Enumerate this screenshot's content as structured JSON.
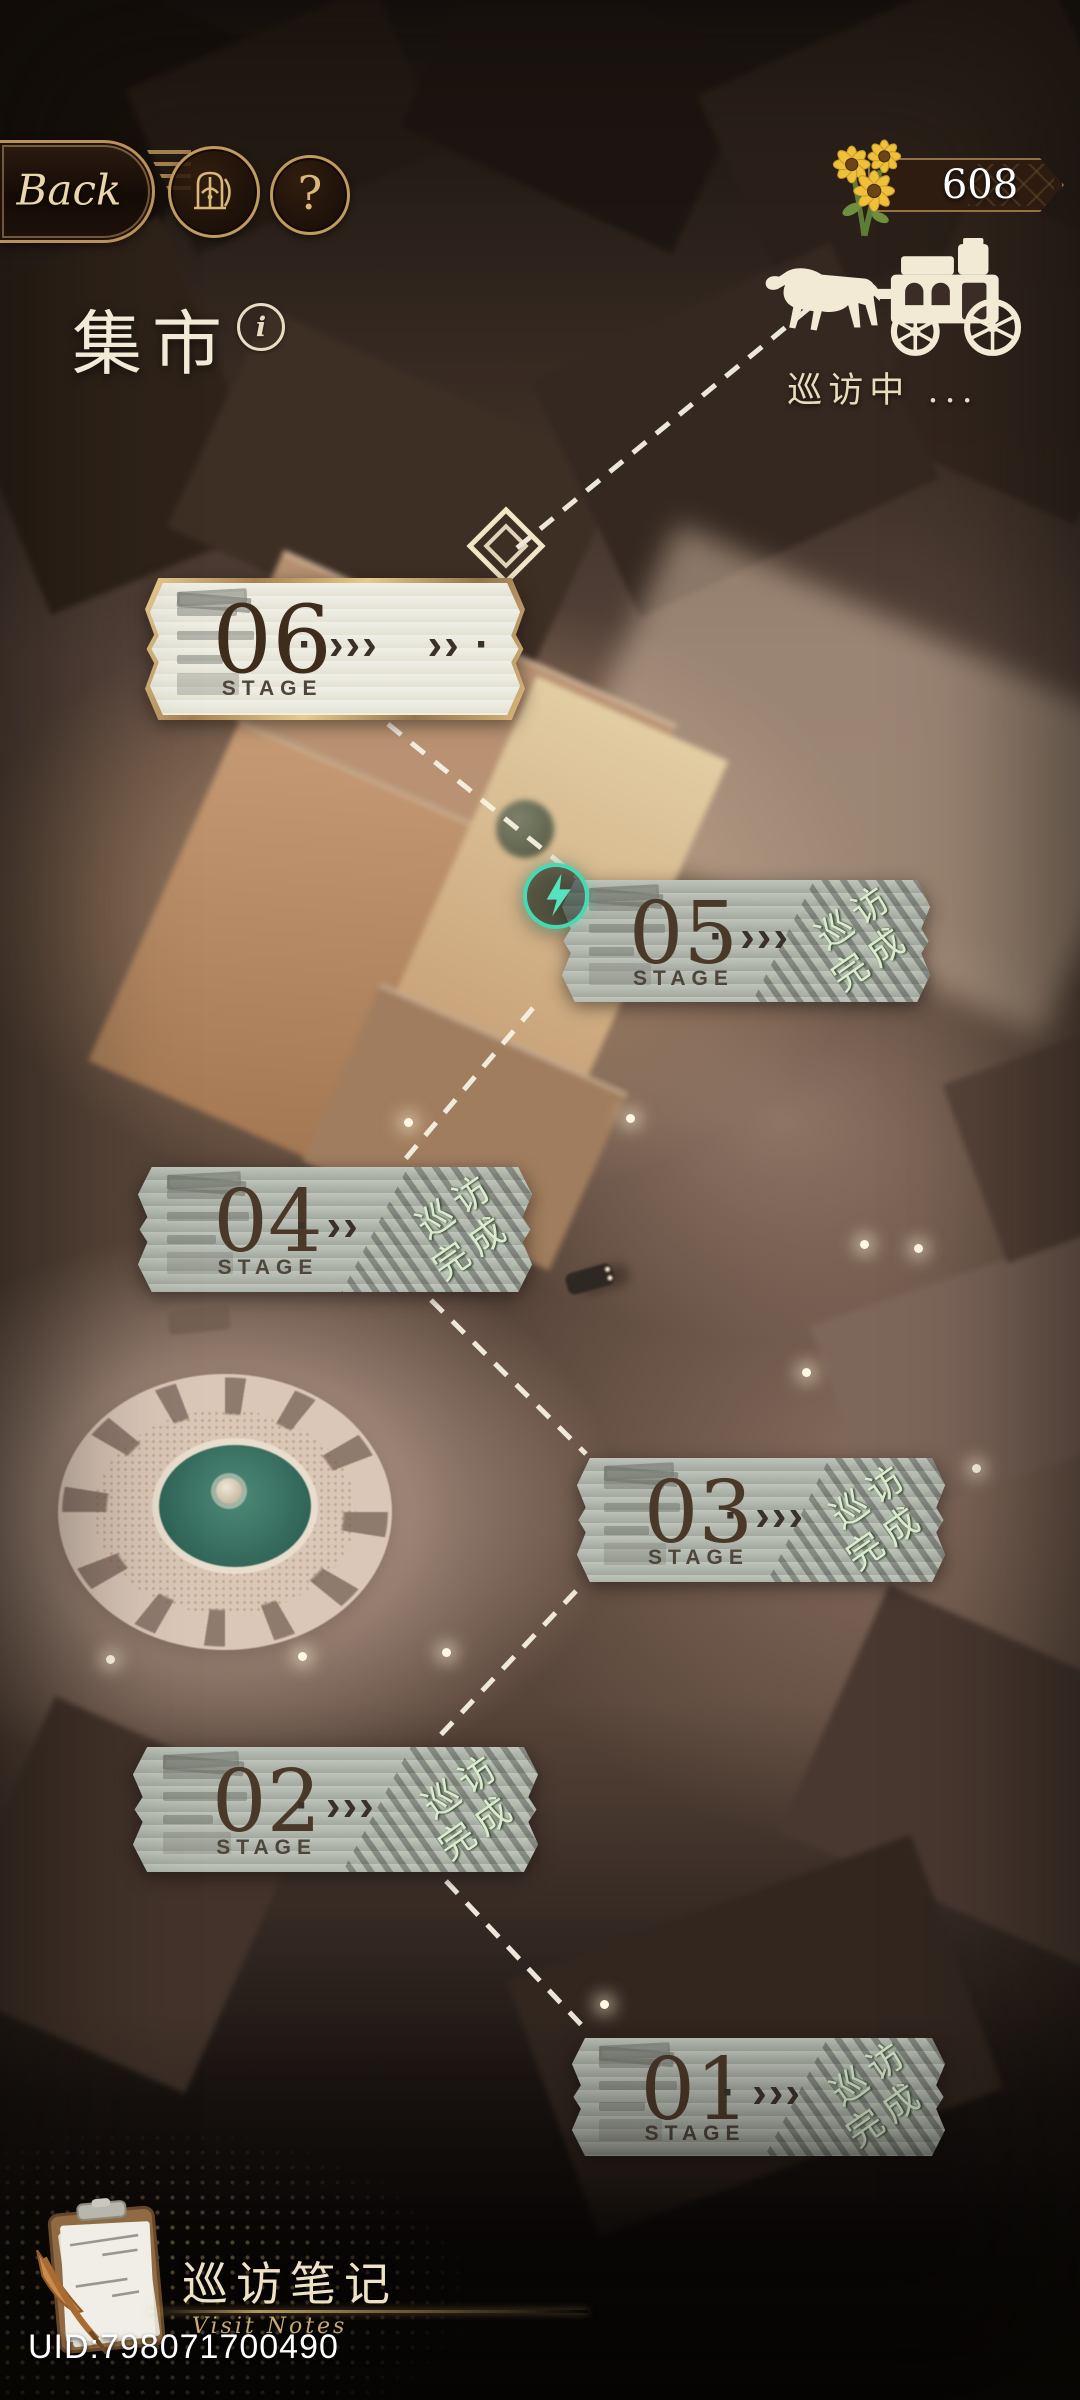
{
  "header": {
    "back_label": "Back",
    "help_label": "?",
    "info_label": "i",
    "title": "集市",
    "currency": {
      "amount": "608",
      "icon": "sunflower-bouquet-icon"
    },
    "caravan": {
      "status": "巡访中 ...",
      "icon": "horse-carriage-icon"
    }
  },
  "stages": [
    {
      "number": "06",
      "label": "STAGE",
      "chevrons": "·  ›››",
      "chevrons2": "››  ·",
      "state": "active"
    },
    {
      "number": "05",
      "label": "STAGE",
      "chevrons": "·  ›››",
      "stamp_top": "巡访",
      "stamp_bottom": "完成",
      "state": "completed",
      "has_lightning": true
    },
    {
      "number": "04",
      "label": "STAGE",
      "chevrons": "·  ››",
      "stamp_top": "巡访",
      "stamp_bottom": "完成",
      "state": "completed"
    },
    {
      "number": "03",
      "label": "STAGE",
      "chevrons": "·  ›››",
      "stamp_top": "巡访",
      "stamp_bottom": "完成",
      "state": "completed"
    },
    {
      "number": "02",
      "label": "STAGE",
      "chevrons": "·  ›››",
      "stamp_top": "巡访",
      "stamp_bottom": "完成",
      "state": "completed"
    },
    {
      "number": "01",
      "label": "STAGE",
      "chevrons": "·  ›››",
      "stamp_top": "巡访",
      "stamp_bottom": "完成",
      "state": "completed"
    }
  ],
  "footer": {
    "notes_title": "巡访笔记",
    "notes_subtitle": "Visit Notes",
    "uid": "UID:798071700490"
  },
  "icons": {
    "door": "arched-door-icon",
    "help": "question-mark-icon",
    "info": "info-circle-icon",
    "lightning": "lightning-bolt-icon",
    "marker": "diamond-path-marker-icon",
    "notes": "clipboard-quill-icon"
  },
  "colors": {
    "gold": "#c9a569",
    "cream": "#f0e6cf",
    "banner_gray": "#b6bab1",
    "banner_cream": "#ebe9dd",
    "stamp_green": "#2c4a27",
    "stamp_text": "#dcead0",
    "teal": "#47d8b4",
    "number_brown": "#4a3828"
  }
}
